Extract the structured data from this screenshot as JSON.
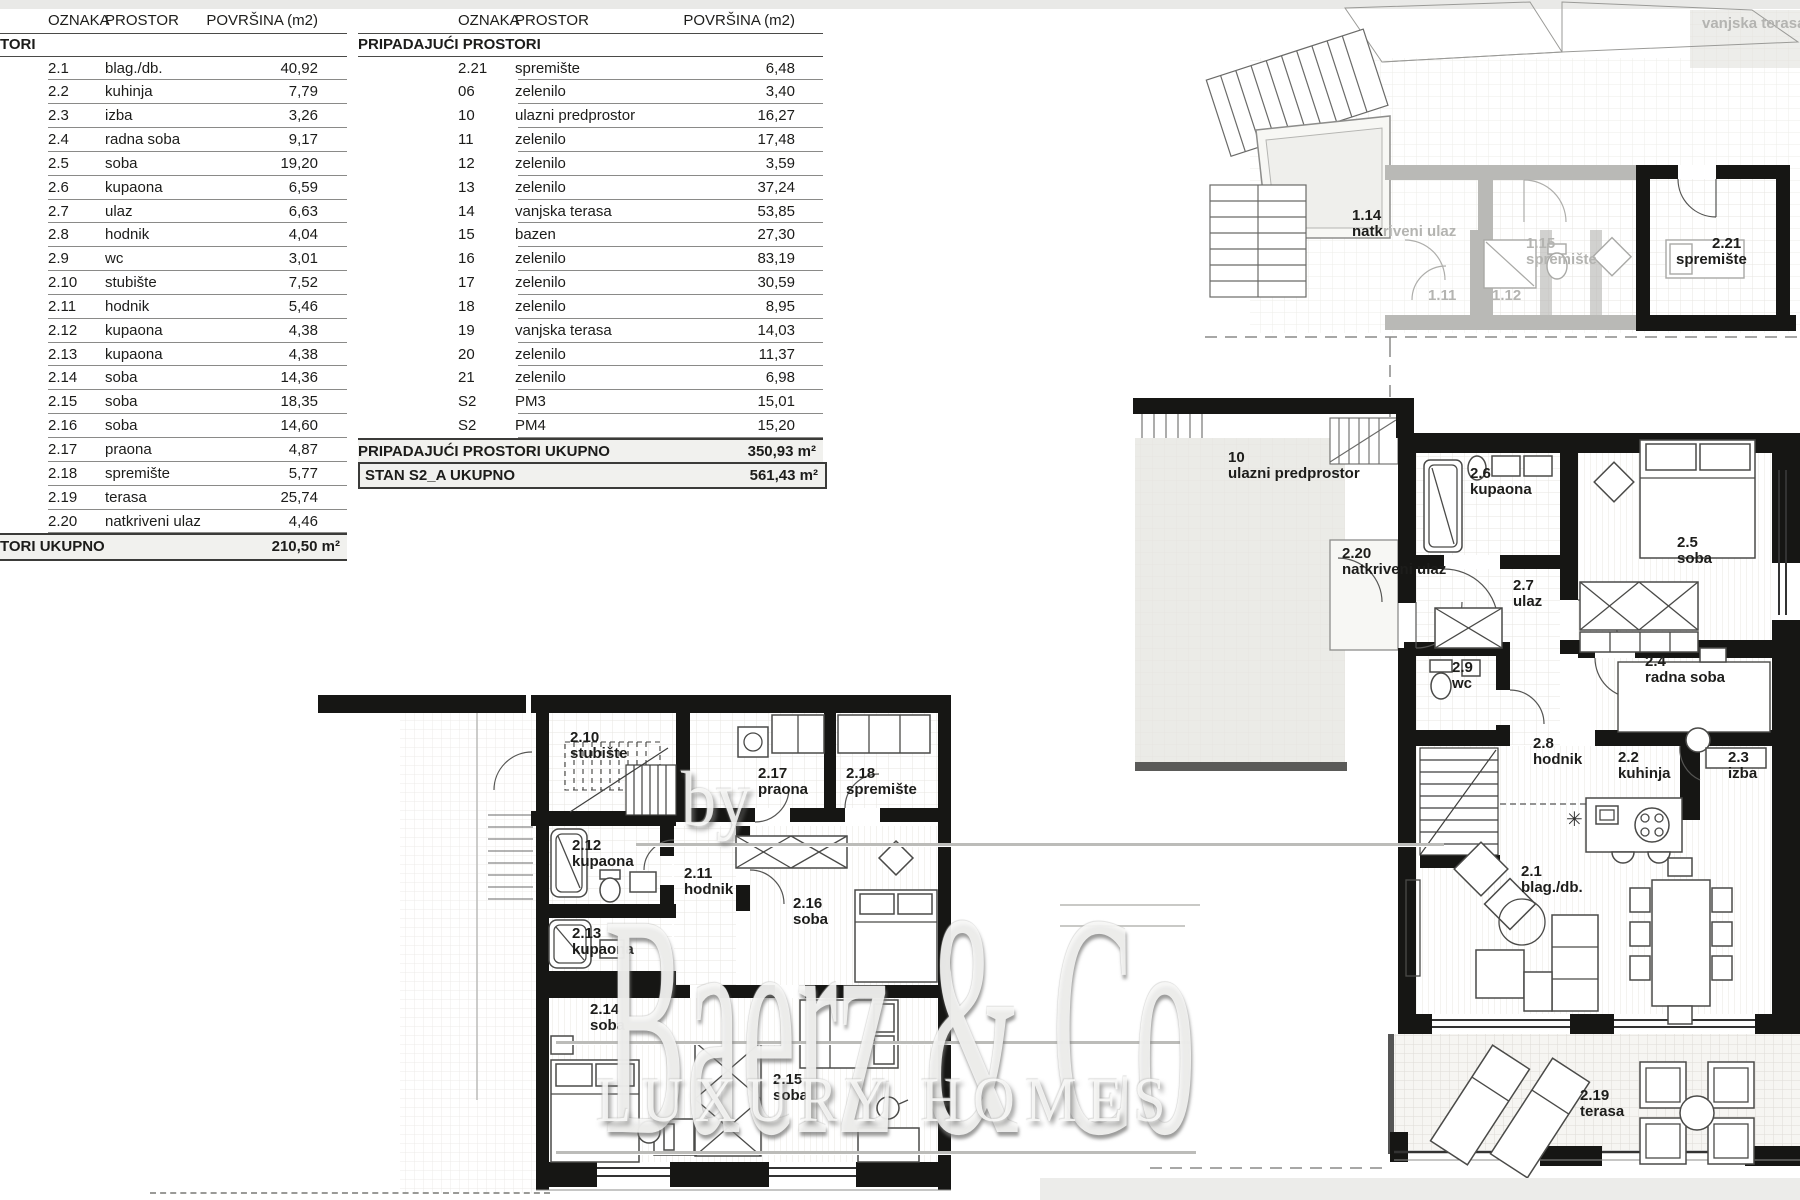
{
  "tables": {
    "left": {
      "headers": [
        "OZNAKA",
        "PROSTOR",
        "POVRŠINA (m2)"
      ],
      "section": "TORI",
      "rows": [
        [
          "2.1",
          "blag./db.",
          "40,92"
        ],
        [
          "2.2",
          "kuhinja",
          "7,79"
        ],
        [
          "2.3",
          "izba",
          "3,26"
        ],
        [
          "2.4",
          "radna soba",
          "9,17"
        ],
        [
          "2.5",
          "soba",
          "19,20"
        ],
        [
          "2.6",
          "kupaona",
          "6,59"
        ],
        [
          "2.7",
          "ulaz",
          "6,63"
        ],
        [
          "2.8",
          "hodnik",
          "4,04"
        ],
        [
          "2.9",
          "wc",
          "3,01"
        ],
        [
          "2.10",
          "stubište",
          "7,52"
        ],
        [
          "2.11",
          "hodnik",
          "5,46"
        ],
        [
          "2.12",
          "kupaona",
          "4,38"
        ],
        [
          "2.13",
          "kupaona",
          "4,38"
        ],
        [
          "2.14",
          "soba",
          "14,36"
        ],
        [
          "2.15",
          "soba",
          "18,35"
        ],
        [
          "2.16",
          "soba",
          "14,60"
        ],
        [
          "2.17",
          "praona",
          "4,87"
        ],
        [
          "2.18",
          "spremište",
          "5,77"
        ],
        [
          "2.19",
          "terasa",
          "25,74"
        ],
        [
          "2.20",
          "natkriveni ulaz",
          "4,46"
        ]
      ],
      "total_label": "TORI UKUPNO",
      "total_value": "210,50 m²"
    },
    "right": {
      "headers": [
        "OZNAKA",
        "PROSTOR",
        "POVRŠINA (m2)"
      ],
      "section": "PRIPADAJUĆI PROSTORI",
      "rows": [
        [
          "2.21",
          "spremište",
          "6,48"
        ],
        [
          "06",
          "zelenilo",
          "3,40"
        ],
        [
          "10",
          "ulazni predprostor",
          "16,27"
        ],
        [
          "11",
          "zelenilo",
          "17,48"
        ],
        [
          "12",
          "zelenilo",
          "3,59"
        ],
        [
          "13",
          "zelenilo",
          "37,24"
        ],
        [
          "14",
          "vanjska terasa",
          "53,85"
        ],
        [
          "15",
          "bazen",
          "27,30"
        ],
        [
          "16",
          "zelenilo",
          "83,19"
        ],
        [
          "17",
          "zelenilo",
          "30,59"
        ],
        [
          "18",
          "zelenilo",
          "8,95"
        ],
        [
          "19",
          "vanjska terasa",
          "14,03"
        ],
        [
          "20",
          "zelenilo",
          "11,37"
        ],
        [
          "21",
          "zelenilo",
          "6,98"
        ],
        [
          "S2",
          "PM3",
          "15,01"
        ],
        [
          "S2",
          "PM4",
          "15,20"
        ]
      ],
      "subtotal_label": "PRIPADAJUĆI PROSTORI UKUPNO",
      "subtotal_value": "350,93 m²",
      "total_label": "STAN S2_A UKUPNO",
      "total_value": "561,43 m²"
    }
  },
  "plan_labels": [
    {
      "code": "",
      "name": "vanjska terasa",
      "x": 1702,
      "y": 16,
      "gray": true
    },
    {
      "code": "1.14",
      "name": "riveni ulaz",
      "x": 1352,
      "y": 208,
      "dark_part": "natk"
    },
    {
      "code": "1.15",
      "name": "spremište",
      "x": 1526,
      "y": 236,
      "gray": true
    },
    {
      "code": "2.21",
      "name": "spremište",
      "x": 1676,
      "y": 236,
      "indent": 36
    },
    {
      "code": "1.11",
      "name": "",
      "x": 1428,
      "y": 288,
      "gray": true
    },
    {
      "code": "1.12",
      "name": "",
      "x": 1492,
      "y": 288,
      "gray": true
    },
    {
      "code": "10",
      "name": "ulazni predprostor",
      "x": 1228,
      "y": 450
    },
    {
      "code": "2.6",
      "name": "kupaona",
      "x": 1470,
      "y": 466
    },
    {
      "code": "2.20",
      "name": "natkriveni ulaz",
      "x": 1342,
      "y": 546
    },
    {
      "code": "2.5",
      "name": "soba",
      "x": 1677,
      "y": 535
    },
    {
      "code": "2.7",
      "name": "ulaz",
      "x": 1513,
      "y": 578
    },
    {
      "code": "2.9",
      "name": "wc",
      "x": 1452,
      "y": 660
    },
    {
      "code": "2.4",
      "name": "radna soba",
      "x": 1645,
      "y": 654
    },
    {
      "code": "2.8",
      "name": "hodnik",
      "x": 1533,
      "y": 736
    },
    {
      "code": "2.2",
      "name": "kuhinja",
      "x": 1618,
      "y": 750
    },
    {
      "code": "2.3",
      "name": "izba",
      "x": 1728,
      "y": 750
    },
    {
      "code": "2.1",
      "name": "blag./db.",
      "x": 1521,
      "y": 864
    },
    {
      "code": "2.19",
      "name": "terasa",
      "x": 1580,
      "y": 1088
    },
    {
      "code": "2.10",
      "name": "stubište",
      "x": 570,
      "y": 730
    },
    {
      "code": "2.17",
      "name": "praona",
      "x": 758,
      "y": 766
    },
    {
      "code": "2.18",
      "name": "spremište",
      "x": 846,
      "y": 766
    },
    {
      "code": "2.12",
      "name": "kupaona",
      "x": 572,
      "y": 838
    },
    {
      "code": "2.11",
      "name": "hodnik",
      "x": 684,
      "y": 866
    },
    {
      "code": "2.16",
      "name": "soba",
      "x": 793,
      "y": 896
    },
    {
      "code": "2.13",
      "name": "kupaona",
      "x": 572,
      "y": 926
    },
    {
      "code": "2.14",
      "name": "soba",
      "x": 590,
      "y": 1002
    },
    {
      "code": "2.15",
      "name": "soba",
      "x": 773,
      "y": 1072
    }
  ],
  "watermark": {
    "by": "by",
    "brand": "Baerz & Co",
    "tagline": "LUXURY HOMES"
  },
  "colors": {
    "wall": "#161614",
    "faded": "#b9b9b6",
    "accent_bg": "#f1f1ee",
    "grid": "#e4e2dd"
  }
}
